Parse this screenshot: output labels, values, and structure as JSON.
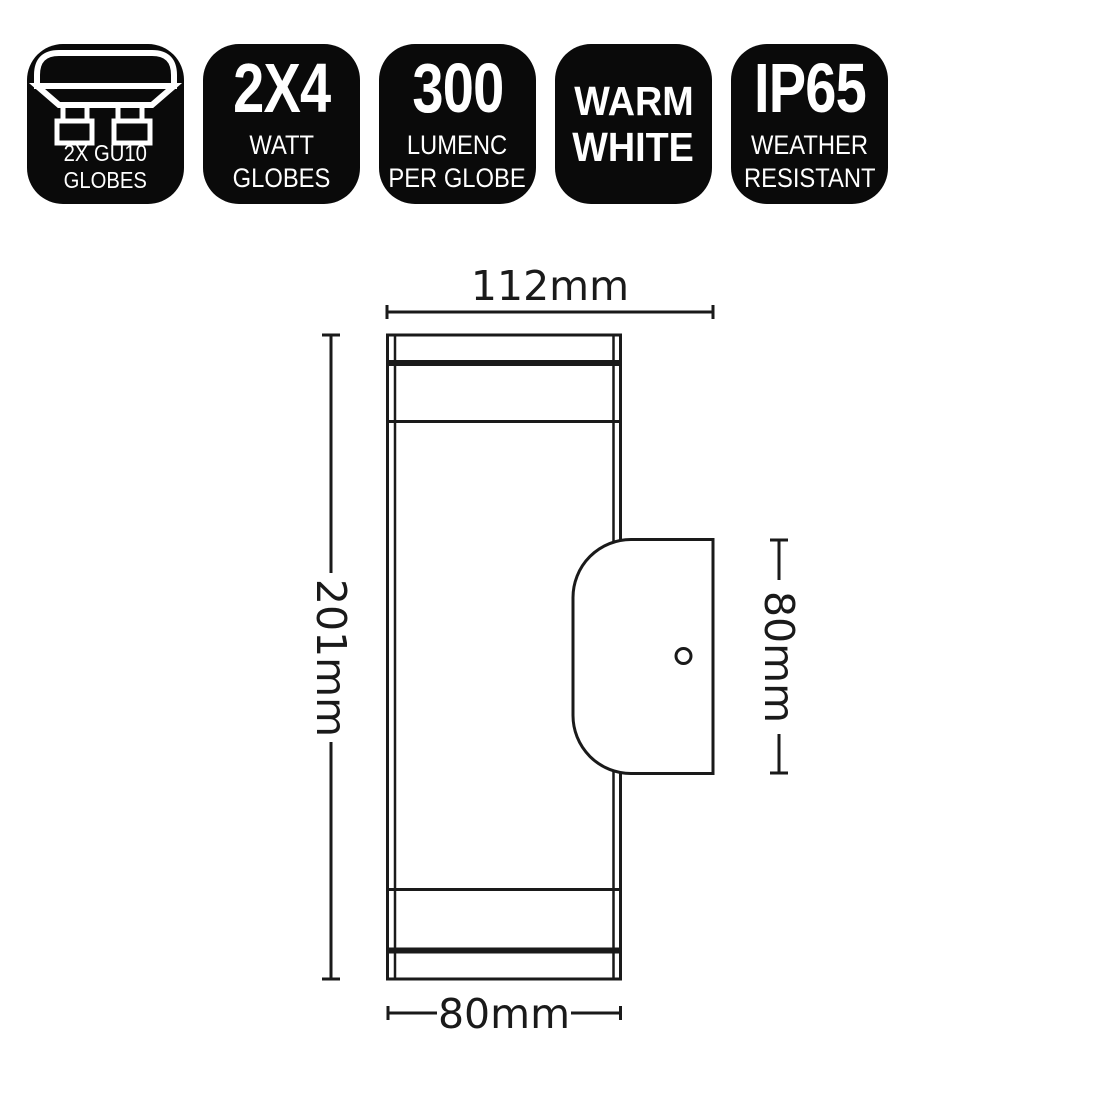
{
  "colors": {
    "background": "#ffffff",
    "badge_bg": "#0a0a0a",
    "badge_text": "#ffffff",
    "line": "#1a1a1a"
  },
  "badges": [
    {
      "id": "gu10-globes",
      "icon": "gu10-twin-downlight-icon",
      "lines": [
        "2X GU10",
        "GLOBES"
      ]
    },
    {
      "id": "wattage",
      "big": "2X4",
      "lines": [
        "WATT",
        "GLOBES"
      ]
    },
    {
      "id": "lumens",
      "big": "300",
      "lines": [
        "LUMENC",
        "PER GLOBE"
      ]
    },
    {
      "id": "colour-temp",
      "lines": [
        "WARM",
        "WHITE"
      ]
    },
    {
      "id": "ip-rating",
      "big": "IP65",
      "lines": [
        "WEATHER",
        "RESISTANT"
      ]
    }
  ],
  "diagram": {
    "overall_width": "112mm",
    "body_height": "201mm",
    "bracket_height": "80mm",
    "body_width": "80mm"
  }
}
